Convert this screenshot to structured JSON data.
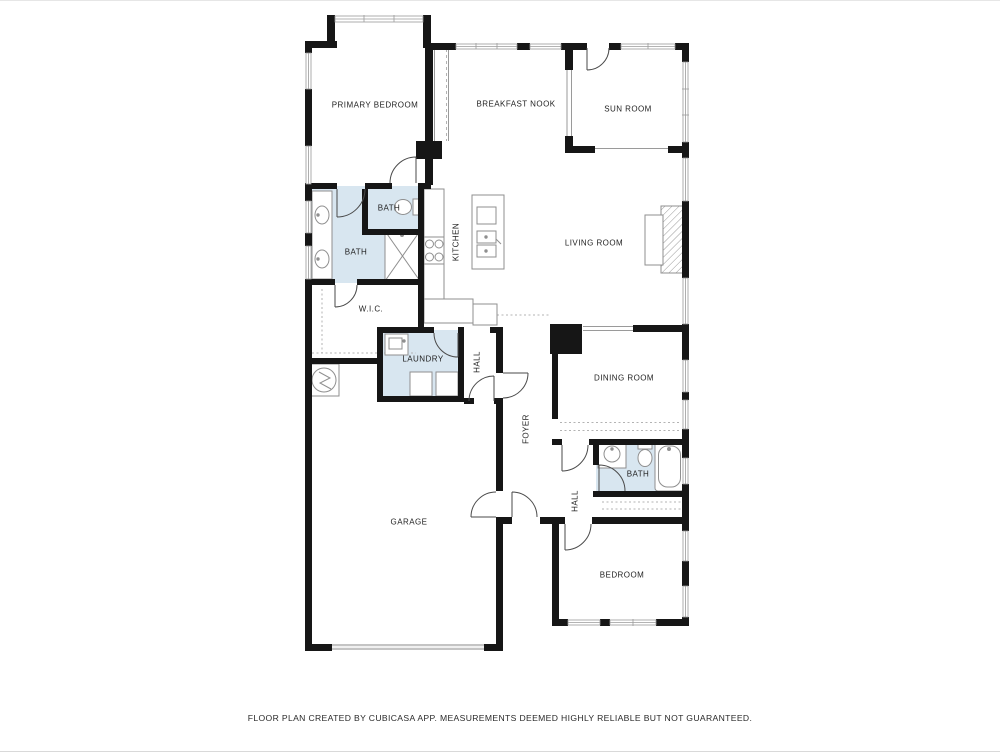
{
  "colors": {
    "wall": "#161616",
    "wet_room_fill": "#d8e6f0",
    "fixture_stroke": "#8f8f8f",
    "door_stroke": "#4a4a4a",
    "window_stroke": "#9a9a9a",
    "dash_stroke": "#b3b3b3",
    "garage_door_fill": "#c4c4c4"
  },
  "rooms": [
    {
      "id": "primary-bedroom",
      "label": "PRIMARY BEDROOM",
      "orientation": "horizontal"
    },
    {
      "id": "breakfast-nook",
      "label": "BREAKFAST NOOK",
      "orientation": "horizontal"
    },
    {
      "id": "sun-room",
      "label": "SUN ROOM",
      "orientation": "horizontal"
    },
    {
      "id": "bath-toilet",
      "label": "BATH",
      "orientation": "horizontal"
    },
    {
      "id": "bath-primary",
      "label": "BATH",
      "orientation": "horizontal"
    },
    {
      "id": "kitchen",
      "label": "KITCHEN",
      "orientation": "vertical"
    },
    {
      "id": "living-room",
      "label": "LIVING ROOM",
      "orientation": "horizontal"
    },
    {
      "id": "wic",
      "label": "W.I.C.",
      "orientation": "horizontal"
    },
    {
      "id": "laundry",
      "label": "LAUNDRY",
      "orientation": "horizontal"
    },
    {
      "id": "hall-upper",
      "label": "HALL",
      "orientation": "vertical"
    },
    {
      "id": "foyer",
      "label": "FOYER",
      "orientation": "vertical"
    },
    {
      "id": "dining-room",
      "label": "DINING ROOM",
      "orientation": "horizontal"
    },
    {
      "id": "bath-lower",
      "label": "BATH",
      "orientation": "horizontal"
    },
    {
      "id": "hall-lower",
      "label": "HALL",
      "orientation": "vertical"
    },
    {
      "id": "garage",
      "label": "GARAGE",
      "orientation": "horizontal"
    },
    {
      "id": "bedroom",
      "label": "BEDROOM",
      "orientation": "horizontal"
    }
  ],
  "footer": {
    "text": "FLOOR PLAN CREATED BY CUBICASA APP. MEASUREMENTS DEEMED HIGHLY RELIABLE BUT NOT GUARANTEED."
  }
}
